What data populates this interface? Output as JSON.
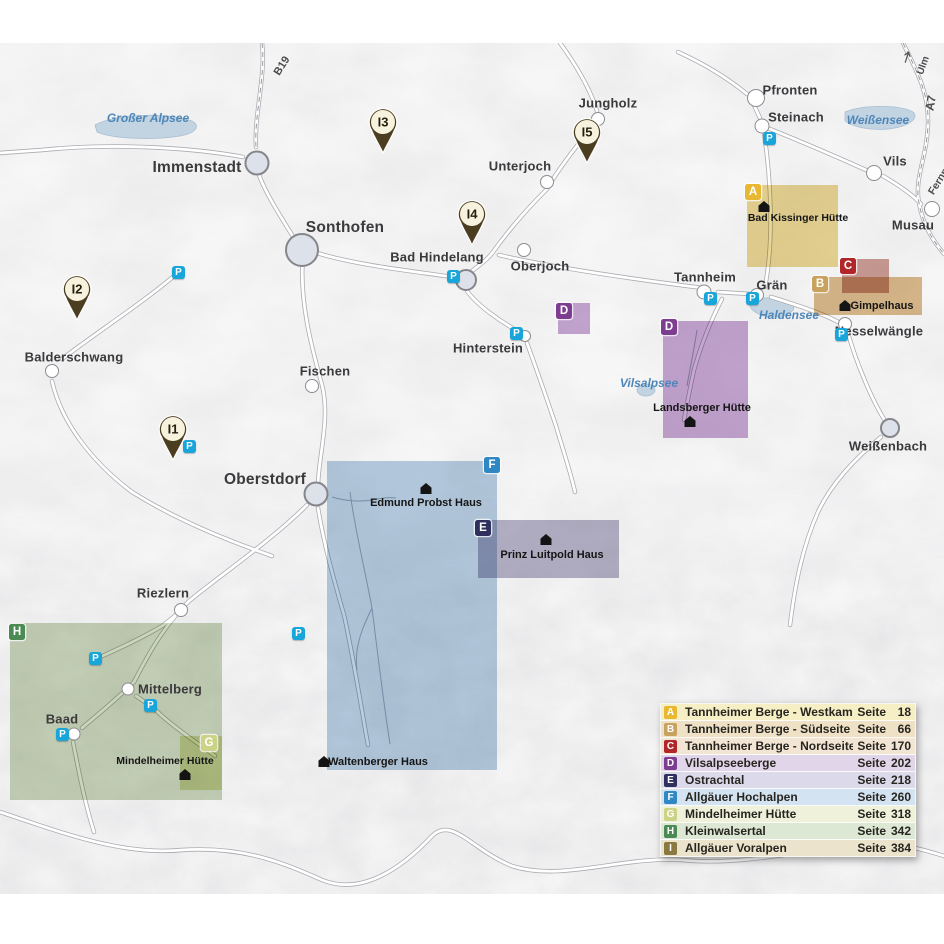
{
  "map": {
    "parking_label": "P",
    "roads": {
      "b19": "B19",
      "a7": "A7",
      "ulm": "Ulm",
      "fernpass": "Fernpass"
    },
    "lakes": {
      "grosser_alpsee": "Großer Alpsee",
      "weissensee": "Weißensee",
      "haldensee": "Haldensee",
      "vilsalpsee": "Vilsalpsee"
    },
    "towns": {
      "immenstadt": "Immenstadt",
      "sonthofen": "Sonthofen",
      "jungholz": "Jungholz",
      "unterjoch": "Unterjoch",
      "oberjoch": "Oberjoch",
      "bad_hindelang": "Bad Hindelang",
      "pfronten": "Pfronten",
      "steinach": "Steinach",
      "vils": "Vils",
      "musau": "Musau",
      "tannheim": "Tannheim",
      "graen": "Grän",
      "nesselwaengle": "Nesselwängle",
      "weissenbach": "Weißenbach",
      "hinterstein": "Hinterstein",
      "fischen": "Fischen",
      "balderschwang": "Balderschwang",
      "oberstdorf": "Oberstdorf",
      "riezlern": "Riezlern",
      "mittelberg": "Mittelberg",
      "baad": "Baad"
    },
    "huts": {
      "bad_kissinger": "Bad Kissinger Hütte",
      "gimpelhaus": "Gimpelhaus",
      "landsberger": "Landsberger Hütte",
      "edmund_probst": "Edmund Probst Haus",
      "prinz_luitpold": "Prinz Luitpold Haus",
      "waltenberger": "Waltenberger Haus",
      "mindelheimer": "Mindelheimer Hütte"
    },
    "pins": {
      "i1": "I1",
      "i2": "I2",
      "i3": "I3",
      "i4": "I4",
      "i5": "I5"
    },
    "region_badges": {
      "a": "A",
      "b": "B",
      "c": "C",
      "d": "D",
      "e": "E",
      "f": "F",
      "g": "G",
      "h": "H"
    }
  },
  "legend": {
    "page_word": "Seite",
    "rows": [
      {
        "letter": "A",
        "name": "Tannheimer Berge - Westkamm",
        "page": "18",
        "badge_color": "#e9b832",
        "row_color": "#f6eec5"
      },
      {
        "letter": "B",
        "name": "Tannheimer Berge - Südseite",
        "page": "66",
        "badge_color": "#c9a25e",
        "row_color": "#eee1c6"
      },
      {
        "letter": "C",
        "name": "Tannheimer Berge - Nordseite",
        "page": "170",
        "badge_color": "#b2262a",
        "row_color": "#f3e5d4"
      },
      {
        "letter": "D",
        "name": "Vilsalpseeberge",
        "page": "202",
        "badge_color": "#7d3e92",
        "row_color": "#e1d5e9"
      },
      {
        "letter": "E",
        "name": "Ostrachtal",
        "page": "218",
        "badge_color": "#30305e",
        "row_color": "#dcd9ea"
      },
      {
        "letter": "F",
        "name": "Allgäuer Hochalpen",
        "page": "260",
        "badge_color": "#2f87c3",
        "row_color": "#d4e3f1"
      },
      {
        "letter": "G",
        "name": "Mindelheimer Hütte",
        "page": "318",
        "badge_color": "#ccd387",
        "row_color": "#f0f1da"
      },
      {
        "letter": "H",
        "name": "Kleinwalsertal",
        "page": "342",
        "badge_color": "#4c8a53",
        "row_color": "#dce8d4"
      },
      {
        "letter": "I",
        "name": "Allgäuer Voralpen",
        "page": "384",
        "badge_color": "#8a7940",
        "row_color": "#ebe3cb"
      }
    ]
  },
  "colors": {
    "parking_blue": "#17a5da",
    "pin_brown": "#4b3d20",
    "water_fill": "#c2d4e2",
    "water_label_blue": "#4e86b8",
    "map_background": "#ececee",
    "region_fills": {
      "A": "#e7cf7c",
      "B": "#d4ac72",
      "C": "#c58a80",
      "D": "#bb93c9",
      "E": "#a8a4bd",
      "F": "#a8c3dc",
      "G": "#dde3a8",
      "H": "#b3c49e"
    }
  }
}
